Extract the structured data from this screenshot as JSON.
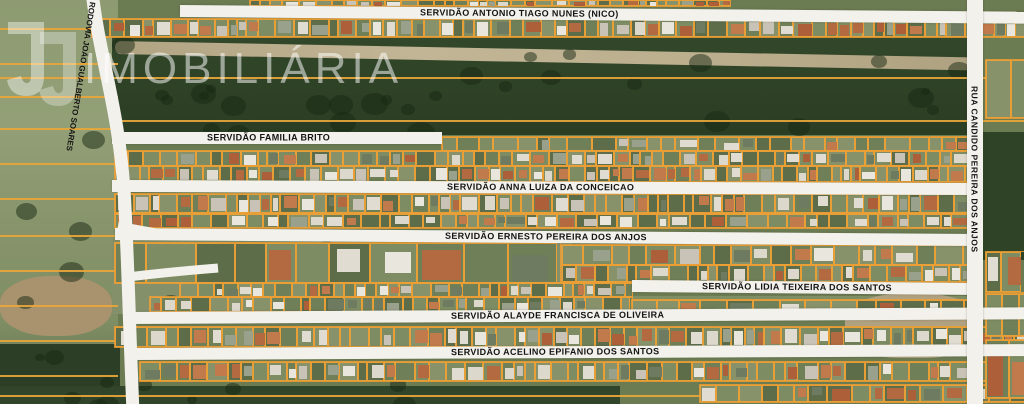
{
  "map": {
    "type": "satellite-parcel-map",
    "roads": {
      "antonio_tiago": "SERVIDÃO ANTONIO TIAGO NUNES (NICO)",
      "rodovia": "RODOVIA JOÃO GUALBERTO SOARES",
      "familia_brito": "SERVIDÃO FAMILIA BRITO",
      "anna_luiza": "SERVIDÃO ANNA LUIZA DA CONCEICAO",
      "ernesto": "SERVIDÃO ERNESTO PEREIRA DOS ANJOS",
      "lidia": "SERVIDÃO LIDIA TEIXEIRA DOS SANTOS",
      "alayde": "SERVIDÃO ALAYDE FRANCISCA DE OLIVEIRA",
      "acelino": "SERVIDÃO ACELINO EPIFANIO DOS SANTOS",
      "rua_candido": "RUA CANDIDO PEREIRA DOS ANJOS"
    },
    "colors": {
      "parcel_outline": "#EDA135",
      "road_fill": "#F3F1EC",
      "road_text": "#141414",
      "forest_green": "#2F4327",
      "field_green": "#8E9B72"
    }
  },
  "watermark": {
    "brand": "IMOBILIÁRIA"
  }
}
